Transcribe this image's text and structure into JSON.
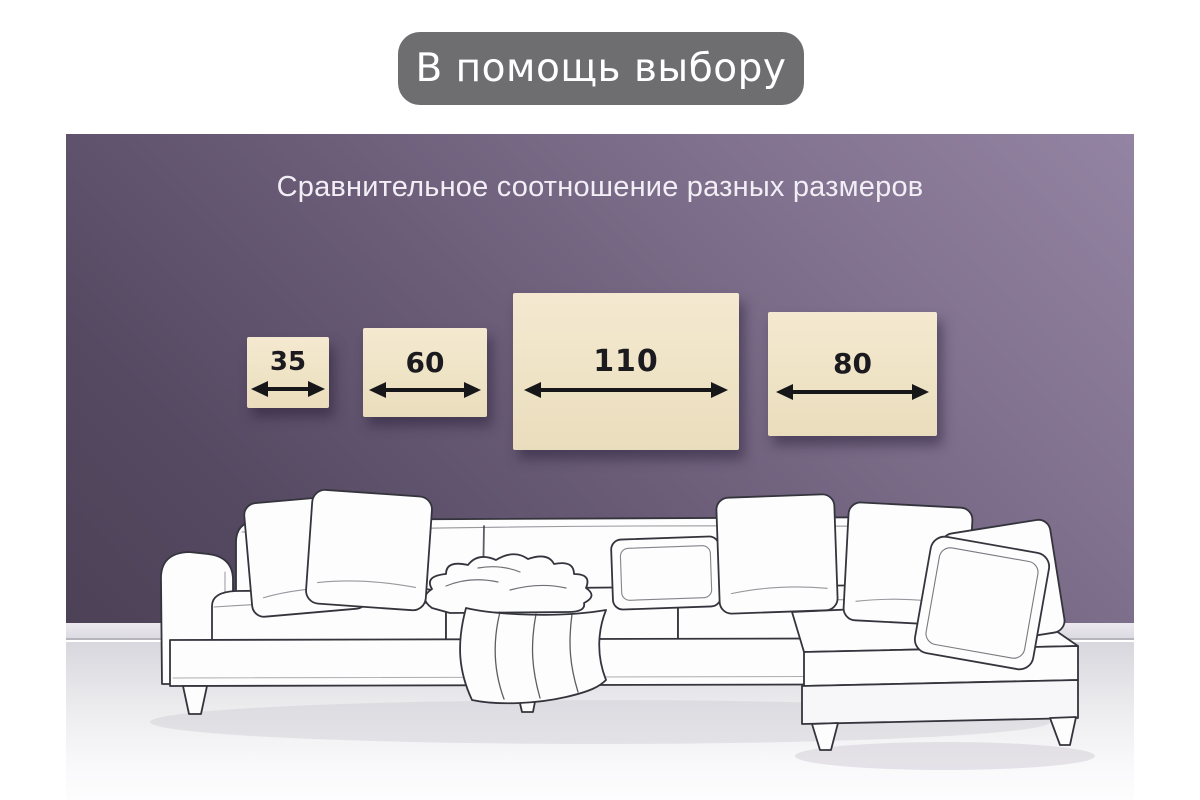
{
  "header": {
    "badge_label": "В помощь выбору"
  },
  "panel": {
    "subtitle": "Сравнительное соотношение разных размеров",
    "sizes": [
      {
        "label": "35"
      },
      {
        "label": "60"
      },
      {
        "label": "110"
      },
      {
        "label": "80"
      }
    ],
    "illustration": "white line-drawn sectional sofa with pillows and throw blanket"
  },
  "colors": {
    "badge_bg": "#6e6e70",
    "badge_text": "#ffffff",
    "wall_light": "#9484a3",
    "wall_dark": "#4c4156",
    "swatch_cream": "#efe3c6",
    "arrow_black": "#17171a",
    "subtitle_text": "#f2eef5"
  }
}
